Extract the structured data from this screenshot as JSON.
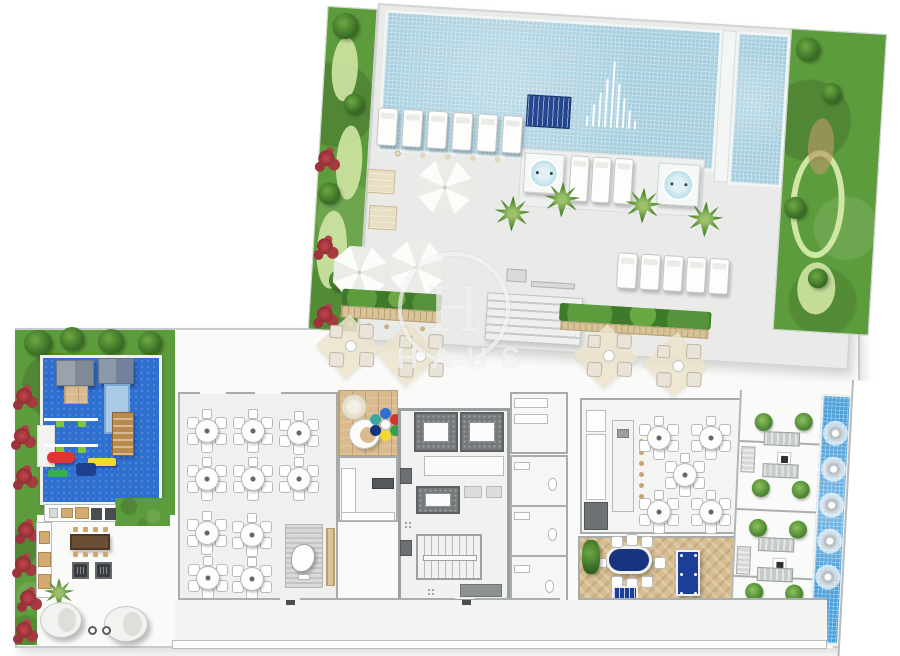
{
  "watermark": {
    "monogram": "H",
    "text": "HAUS"
  },
  "palette": {
    "pool_water": "#a6cede",
    "facade_blue": "#4d9fd8",
    "navy_felt": "#1c3e96",
    "play_mat_blue": "#2e6fd0",
    "grass_green": "#5d9c3c",
    "wood_tan": "#d9bb8f",
    "deck_gray": "#eaeae8",
    "flower_red": "#b2383f"
  },
  "inventory": {
    "pools": 2,
    "hot_tubs": 2,
    "pool_loungers_upper_row": 6,
    "pool_loungers_lower_row": 5,
    "in_pool_loungers": 3,
    "sun_umbrellas": 3,
    "palm_trees": 5,
    "party_room_tables": 10,
    "seats_per_round_table": 6,
    "gourmet_tables": 5,
    "gourmet_island_stools": 7,
    "game_room_card_tables": 1,
    "game_room_billiard_tables": 1,
    "game_room_foosball_tables": 1,
    "terrace_grill_modules": 4,
    "facade_round_vents": 5,
    "playground_play_houses": 2,
    "round_daybeds": 2
  }
}
